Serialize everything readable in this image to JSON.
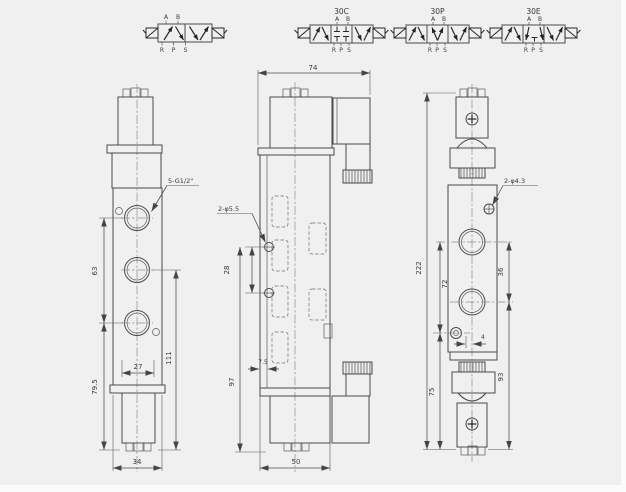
{
  "page": {
    "background": "#f0f0f0",
    "line_color": "#4a4a4a"
  },
  "schematic": {
    "plain": {
      "a": "A",
      "b": "B",
      "r": "R",
      "p": "P",
      "s": "S"
    },
    "variants": [
      {
        "title": "30C",
        "a": "A",
        "b": "B",
        "r": "R",
        "p": "P",
        "s": "S"
      },
      {
        "title": "30P",
        "a": "A",
        "b": "B",
        "r": "R",
        "p": "P",
        "s": "S"
      },
      {
        "title": "30E",
        "a": "A",
        "b": "B",
        "r": "R",
        "p": "P",
        "s": "S"
      }
    ]
  },
  "front_view": {
    "dims": {
      "thread": "5-G1/2\"",
      "port_spacing": "63",
      "pilot_width": "27",
      "height_right": "111",
      "height_left": "79.5",
      "width": "34"
    }
  },
  "side_view": {
    "dims": {
      "top_width": "74",
      "mount_holes": "2-φ5.5",
      "hole_spacing": "28",
      "height": "97",
      "wall": "7.5",
      "bottom_width": "50"
    }
  },
  "rear_view": {
    "dims": {
      "pin_holes": "2-φ4.3",
      "total_height": "222",
      "upper_span": "72",
      "port_span": "36",
      "pin_offset": "4",
      "lower_left_span": "75",
      "lower_right_span": "93"
    }
  }
}
